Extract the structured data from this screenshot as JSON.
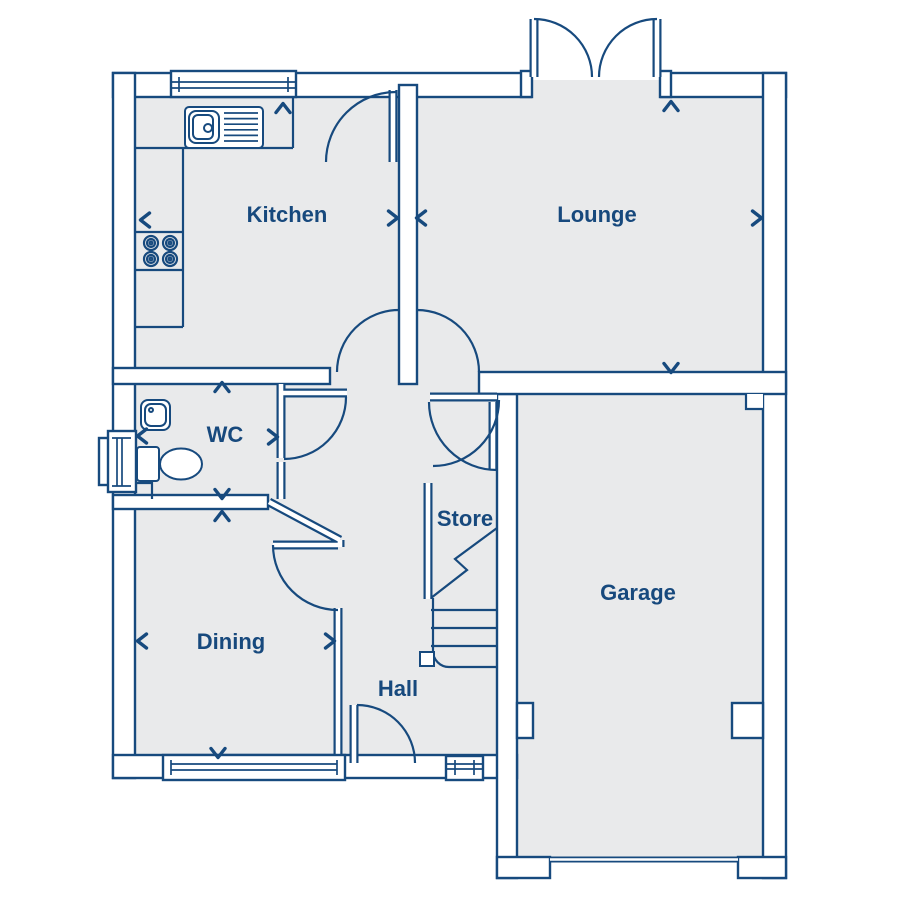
{
  "title": "Ground floor plan",
  "rooms": {
    "kitchen": "Kitchen",
    "lounge": "Lounge",
    "wc": "WC",
    "dining": "Dining",
    "hall": "Hall",
    "store": "Store",
    "garage": "Garage"
  },
  "colors": {
    "line": "#174a7e",
    "label": "#17497d",
    "room_fill": "#e9eaeb",
    "wall_fill": "#ffffff",
    "background": "#ffffff"
  },
  "icons": [
    "sink-icon",
    "hob-icon",
    "toilet-icon",
    "basin-icon",
    "stairs-icon",
    "french-doors-icon",
    "door-swing-icon",
    "window-icon",
    "dimension-chevron-icon"
  ]
}
